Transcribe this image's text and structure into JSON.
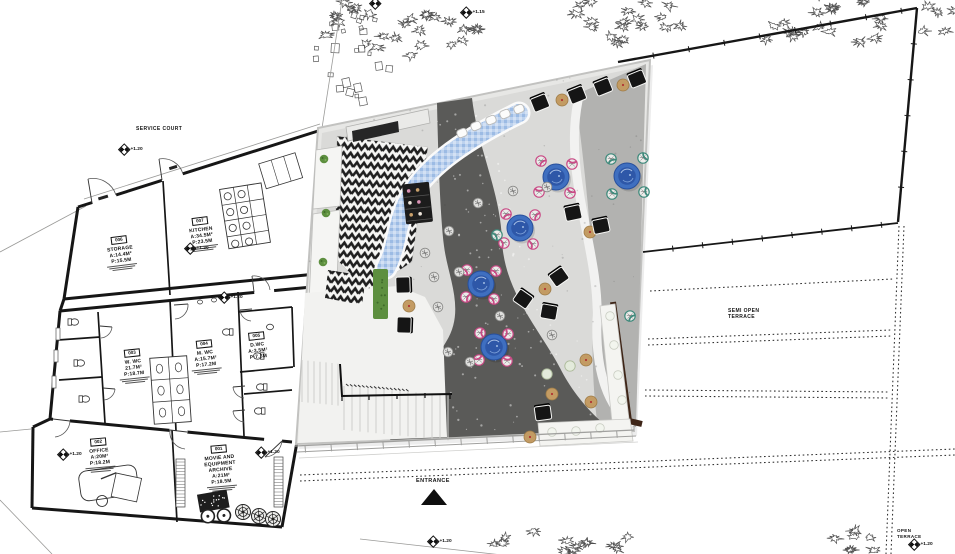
{
  "labels": {
    "service_court": "SERVICE COURT",
    "entrance": "ENTRANCE",
    "semi_open_terrace": [
      "SEMI OPEN",
      "TERRACE"
    ],
    "open_terrace": [
      "OPEN",
      "TERRACE"
    ]
  },
  "markers": [
    {
      "x": 123,
      "y": 148,
      "label": "+1.20"
    },
    {
      "x": 189,
      "y": 247,
      "label": "+1.20"
    },
    {
      "x": 223,
      "y": 296,
      "label": "+1.20"
    },
    {
      "x": 62,
      "y": 453,
      "label": "+1.20"
    },
    {
      "x": 260,
      "y": 451,
      "label": "+1.20"
    },
    {
      "x": 432,
      "y": 540,
      "label": "+1.20"
    },
    {
      "x": 465,
      "y": 11,
      "label": "+1.15"
    },
    {
      "x": 374,
      "y": 2,
      "label": ""
    },
    {
      "x": 913,
      "y": 543,
      "label": "+1.20"
    }
  ],
  "rooms": [
    {
      "number": "006",
      "name_lines": [
        "STORAGE"
      ],
      "area": "A:14.4M²",
      "perimeter": "P:15.5M",
      "cx": 120,
      "top": 228,
      "rot": -7,
      "notes": true
    },
    {
      "number": "007",
      "name_lines": [
        "KITCHEN"
      ],
      "area": "A:34.5M²",
      "perimeter": "P:23.5M",
      "cx": 201,
      "top": 209,
      "rot": -7,
      "notes": true
    },
    {
      "number": "003",
      "name_lines": [
        "W. WC"
      ],
      "area": "21.7M²",
      "perimeter": "P:18.7M",
      "cx": 133,
      "top": 341,
      "rot": -6,
      "notes": true
    },
    {
      "number": "004",
      "name_lines": [
        "M. WC"
      ],
      "area": "A:15.7M²",
      "perimeter": "P:17.2M",
      "cx": 205,
      "top": 332,
      "rot": -6,
      "notes": true
    },
    {
      "number": "005",
      "name_lines": [
        "D.WC"
      ],
      "area": "A:3.5M²",
      "perimeter": "P:7.3M",
      "cx": 257,
      "top": 324,
      "rot": -6,
      "notes": false
    },
    {
      "number": "002",
      "name_lines": [
        "OFFICE"
      ],
      "area": "A:20M²",
      "perimeter": "P:18.2M",
      "cx": 99,
      "top": 430,
      "rot": -5,
      "notes": true
    },
    {
      "number": "001",
      "name_lines": [
        "MOVIE AND",
        "EQUIPMENT",
        "ARCHIVE"
      ],
      "area": "A:21M²",
      "perimeter": "P:18.5M",
      "cx": 220,
      "top": 437,
      "rot": -5,
      "notes": true
    }
  ],
  "scene": {
    "black_chairs": [
      [
        540,
        103,
        -22
      ],
      [
        577,
        95,
        -22
      ],
      [
        603,
        87,
        -22
      ],
      [
        637,
        79,
        -22
      ],
      [
        573,
        213,
        -12
      ],
      [
        601,
        226,
        -12
      ],
      [
        403,
        285,
        88
      ],
      [
        404,
        325,
        92
      ],
      [
        523,
        299,
        35
      ],
      [
        559,
        277,
        -35
      ],
      [
        549,
        312,
        10
      ],
      [
        543,
        413,
        -8
      ]
    ],
    "tan_poufs": [
      [
        562,
        100
      ],
      [
        623,
        85
      ],
      [
        590,
        232
      ],
      [
        409,
        306
      ],
      [
        545,
        289
      ],
      [
        586,
        360
      ],
      [
        552,
        394
      ],
      [
        591,
        402
      ],
      [
        530,
        437
      ]
    ],
    "blue_tables": [
      [
        556,
        177
      ],
      [
        627,
        176
      ],
      [
        520,
        228
      ],
      [
        481,
        284
      ],
      [
        494,
        347
      ]
    ],
    "pink_chairs": [
      [
        541,
        161
      ],
      [
        572,
        164
      ],
      [
        539,
        192
      ],
      [
        570,
        193
      ],
      [
        506,
        214
      ],
      [
        535,
        215
      ],
      [
        504,
        243
      ],
      [
        533,
        244
      ],
      [
        467,
        270
      ],
      [
        496,
        271
      ],
      [
        466,
        297
      ],
      [
        494,
        299
      ],
      [
        480,
        333
      ],
      [
        508,
        334
      ],
      [
        479,
        360
      ],
      [
        507,
        361
      ]
    ],
    "teal_chairs": [
      [
        611,
        159
      ],
      [
        643,
        158
      ],
      [
        612,
        194
      ],
      [
        644,
        192
      ],
      [
        497,
        235
      ],
      [
        630,
        316
      ]
    ],
    "gray_poufs": [
      [
        513,
        191
      ],
      [
        478,
        203
      ],
      [
        449,
        231
      ],
      [
        425,
        253
      ],
      [
        434,
        277
      ],
      [
        547,
        187
      ],
      [
        459,
        272
      ],
      [
        500,
        316
      ],
      [
        552,
        335
      ],
      [
        448,
        352
      ],
      [
        470,
        362
      ],
      [
        438,
        307
      ]
    ],
    "green_poufs": [
      [
        570,
        366
      ],
      [
        547,
        374
      ]
    ],
    "white_stools": [
      [
        462,
        133
      ],
      [
        476,
        126
      ],
      [
        491,
        120
      ],
      [
        505,
        114
      ],
      [
        519,
        109
      ]
    ],
    "bench_pillows": [
      [
        610,
        316
      ],
      [
        614,
        345
      ],
      [
        618,
        375
      ],
      [
        622,
        400
      ],
      [
        552,
        432
      ],
      [
        576,
        431
      ],
      [
        600,
        428
      ]
    ],
    "counter_plants": [
      [
        324,
        159
      ],
      [
        326,
        213
      ],
      [
        323,
        262
      ],
      [
        327,
        297
      ]
    ]
  },
  "trees": [
    {
      "cx": 390,
      "cy": 30,
      "rx": 90,
      "ry": 34,
      "n": 26,
      "type": "blob"
    },
    {
      "cx": 622,
      "cy": 22,
      "rx": 68,
      "ry": 26,
      "n": 18,
      "type": "blob"
    },
    {
      "cx": 812,
      "cy": 22,
      "rx": 80,
      "ry": 28,
      "n": 20,
      "type": "blob"
    },
    {
      "cx": 940,
      "cy": 18,
      "rx": 30,
      "ry": 22,
      "n": 7,
      "type": "blob"
    },
    {
      "cx": 560,
      "cy": 542,
      "rx": 78,
      "ry": 14,
      "n": 14,
      "type": "blob"
    },
    {
      "cx": 860,
      "cy": 542,
      "rx": 36,
      "ry": 12,
      "n": 7,
      "type": "blob"
    },
    {
      "cx": 350,
      "cy": 60,
      "rx": 42,
      "ry": 52,
      "n": 24,
      "type": "square"
    }
  ],
  "colors": {
    "wall_line": "#161616",
    "floor_light": "#dadad8",
    "floor_band": "#b2b2b0",
    "path_dark": "#5a5a58",
    "chevron_dark": "#1f1f1f",
    "mosaic_blue": "#a6c2e6",
    "table_blue": "#3f6fc0",
    "table_blue_dark": "#2d55a6",
    "pink": "#c94b86",
    "teal": "#3f8a7c",
    "tan": "#c39b63",
    "moss": "#5d8f3f",
    "bench_brown": "#3e2517",
    "wall_white": "#f2f2f0"
  }
}
